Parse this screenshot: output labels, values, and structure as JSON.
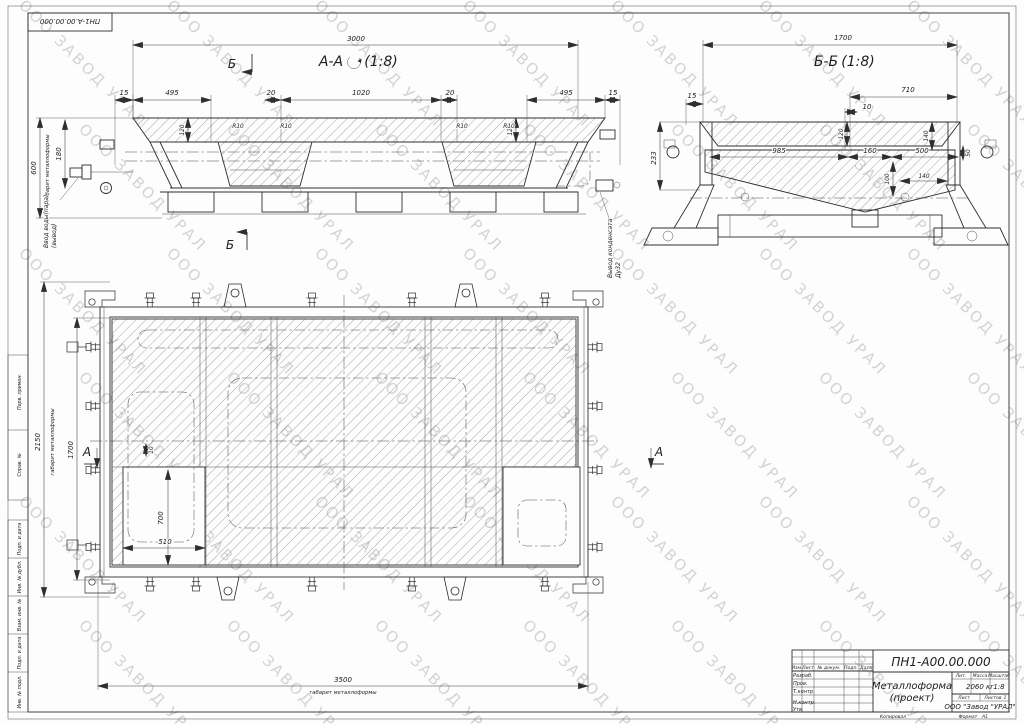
{
  "watermark": {
    "text": "ООО ЗАВОД УРАЛ"
  },
  "corner_stamp": {
    "doc_number": "ПН1-А.00.00.000"
  },
  "frame_stamps": {
    "top": [
      "Перв. примен.",
      "Справ. №"
    ],
    "bottom": [
      "Подп. и дата",
      "Инв. № дубл.",
      "Взам. инв. №",
      "Подп. и дата",
      "Инв. № подл."
    ]
  },
  "section_aa": {
    "title": "А-А",
    "scale": "(1:8)",
    "dim_3000": "3000",
    "dims_top": [
      "15",
      "495",
      "20",
      "1020",
      "20",
      "495",
      "15"
    ],
    "dim_600": "600",
    "dim_180": "180",
    "dim_120": "120",
    "r10": "R10",
    "gabarit": "габарит металлоформы",
    "note_inlet_line1": "Ввод воды(пара)",
    "note_inlet_line2": "(вывод)",
    "note_cond_line1": "Вывод конденсата",
    "note_cond_line2": "Ду32",
    "cut_label": "Б"
  },
  "section_bb": {
    "title": "Б-Б",
    "scale": "(1:8)",
    "dim_1700": "1700",
    "dim_710": "710",
    "dim_10": "10",
    "dim_15": "15",
    "dim_233": "233",
    "dim_120": "120",
    "dim_140_top": "140",
    "dim_985": "985",
    "dim_160": "160",
    "dim_500": "500",
    "dim_50": "50",
    "dim_100": "100",
    "dim_140_bot": "140"
  },
  "plan": {
    "dim_2150": "2150",
    "dim_1700": "1700",
    "dim_3500": "3500",
    "dim_700": "700",
    "dim_510": "510",
    "dim_10": "10",
    "gabarit": "габарит металлоформы",
    "cut_label": "А"
  },
  "title_block": {
    "doc_number": "ПН1-А00.00.000",
    "name_line1": "Металлоформа",
    "name_line2": "(проект)",
    "header_cols": [
      "Изм.",
      "Лист",
      "№ докум.",
      "Подп.",
      "Дата"
    ],
    "rows": [
      "Разраб.",
      "Пров.",
      "Т.контр.",
      "Н.контр.",
      "Утв."
    ],
    "lit_label": "Лит.",
    "mass_label": "Масса",
    "scale_label": "Масштаб",
    "mass_value": "2060 кг",
    "scale_value": "1:8",
    "sheet_label": "Лист",
    "sheets_label": "Листов",
    "sheets_value": "1",
    "company": "ООО \"Завод \"УРАЛ\"",
    "kopiroval": "Копировал",
    "format_label": "Формат",
    "format_value": "А1"
  }
}
